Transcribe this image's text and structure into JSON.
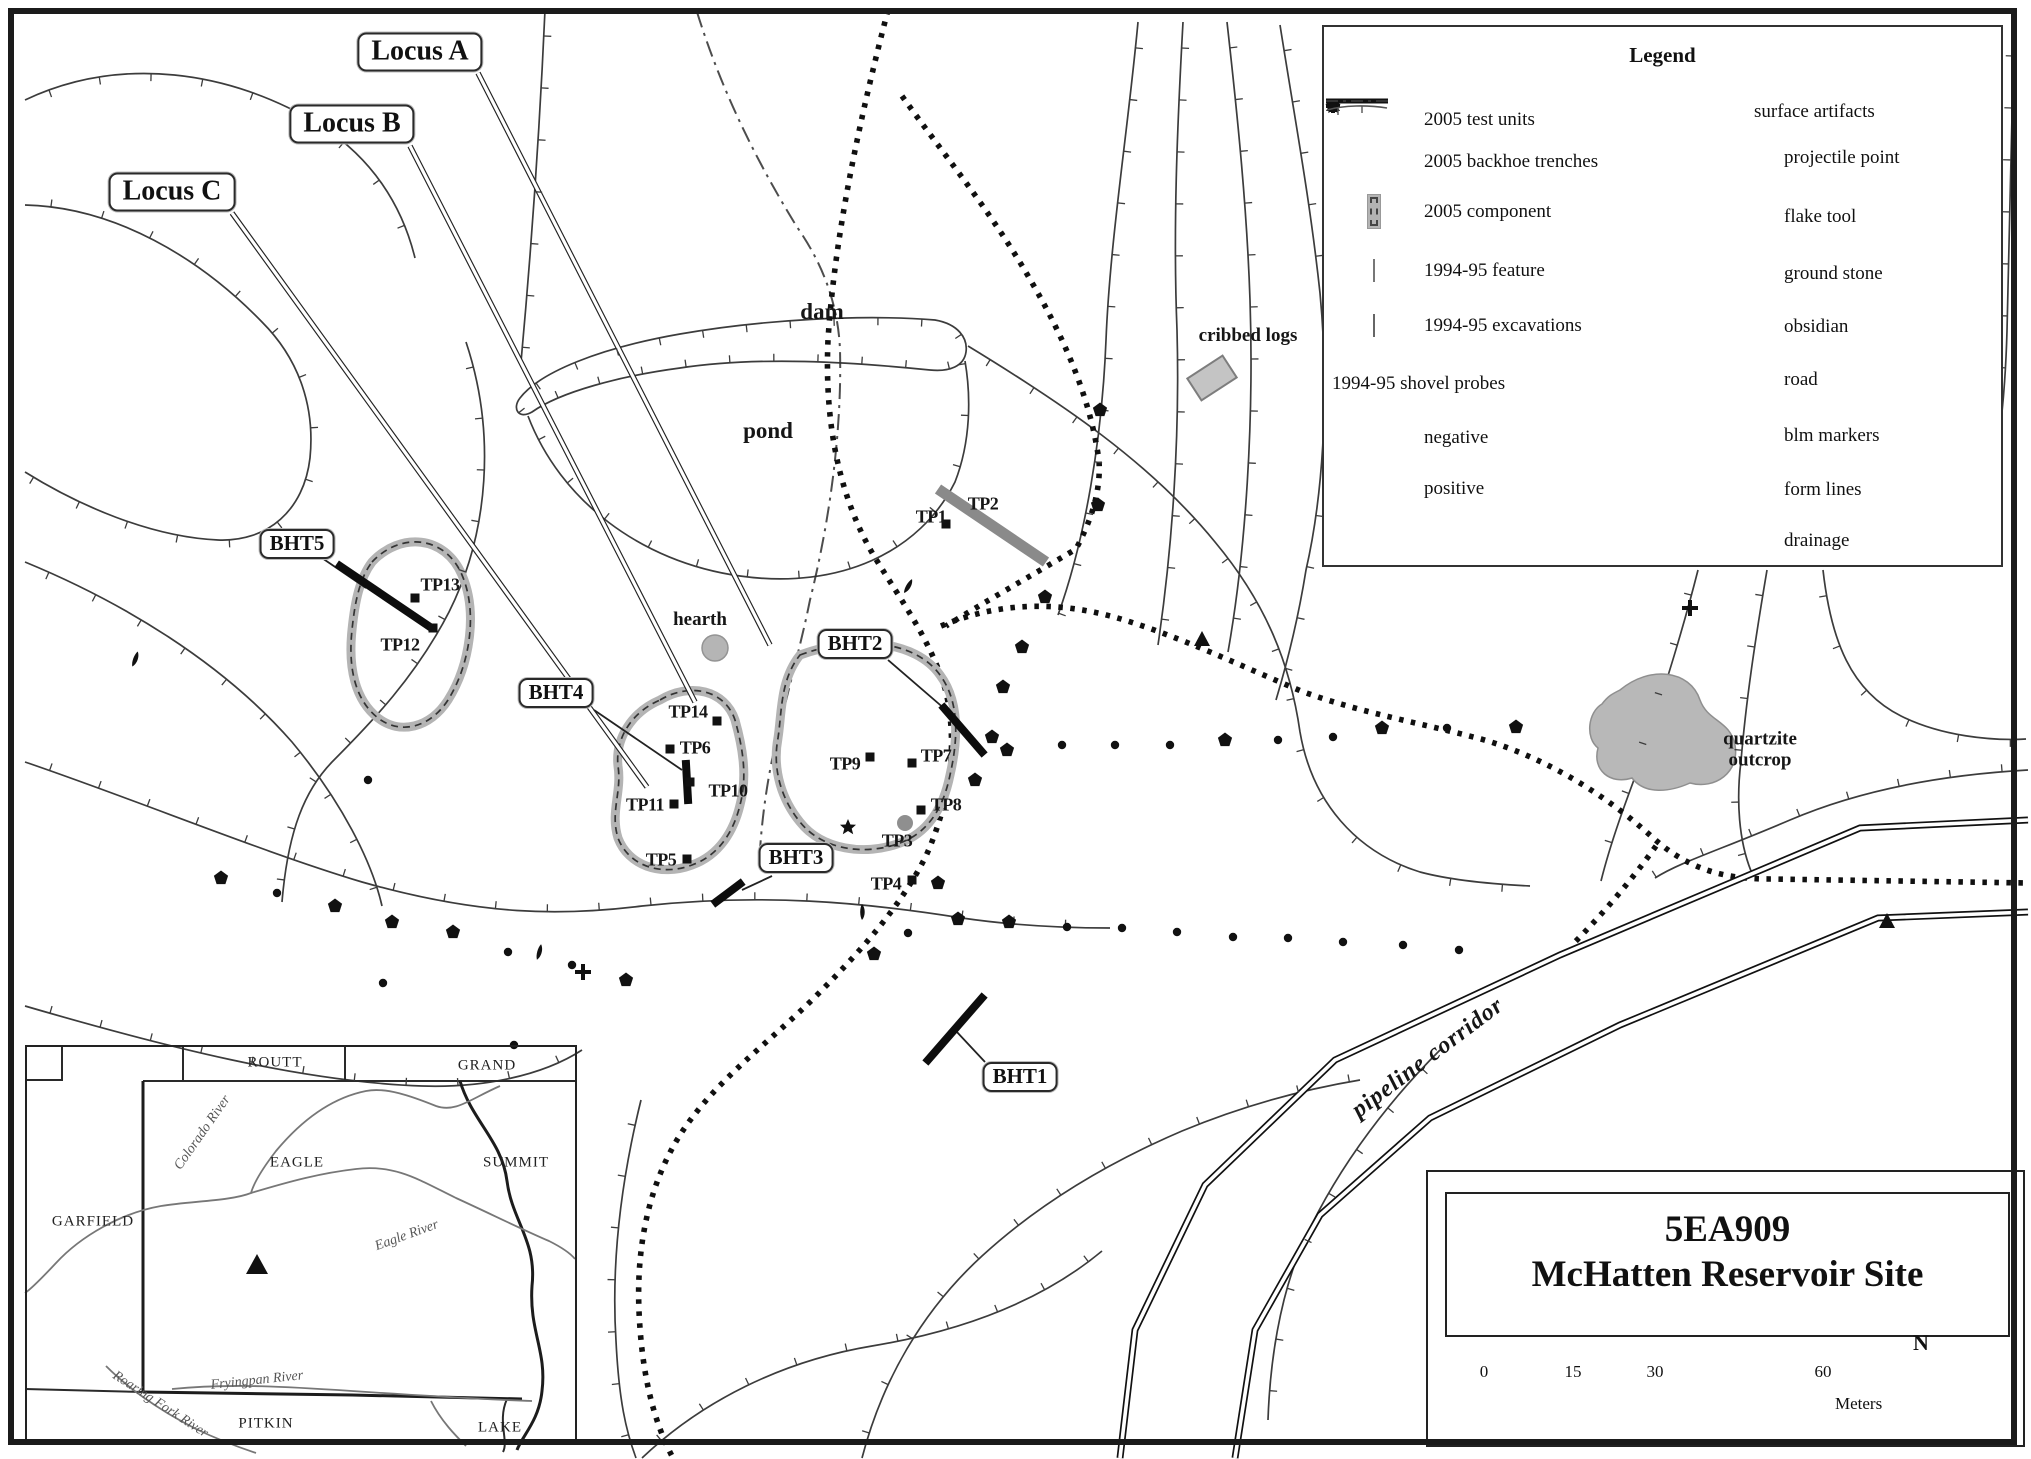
{
  "legend": {
    "title": "Legend",
    "left_items": [
      {
        "icon": "square",
        "label": "2005 test units"
      },
      {
        "icon": "thickline",
        "label": "2005 backhoe trenches"
      },
      {
        "icon": "component",
        "label": "2005 component"
      },
      {
        "icon": "feature",
        "label": "1994-95 feature"
      },
      {
        "icon": "excavation",
        "label": "1994-95 excavations"
      }
    ],
    "probes_heading": "1994-95 shovel probes",
    "probe_items": [
      {
        "icon": "dot",
        "label": "negative"
      },
      {
        "icon": "pentagon",
        "label": "positive"
      }
    ],
    "right_heading": "surface artifacts",
    "right_items": [
      {
        "icon": "leaf",
        "label": "projectile point"
      },
      {
        "icon": "star",
        "label": "flake tool"
      },
      {
        "icon": "cross",
        "label": "ground stone"
      },
      {
        "icon": "smalldot",
        "label": "obsidian"
      },
      {
        "icon": "road",
        "label": "road"
      },
      {
        "icon": "triangle",
        "label": "blm markers"
      },
      {
        "icon": "formline",
        "label": "form lines"
      },
      {
        "icon": "drainage",
        "label": "drainage"
      }
    ]
  },
  "title_block": {
    "site_number": "5EA909",
    "site_name": "McHatten Reservoir Site",
    "scale_ticks": [
      "0",
      "15",
      "30",
      "60"
    ],
    "units_label": "Meters",
    "north_label": "N"
  },
  "map": {
    "callouts": [
      {
        "id": "locus-a",
        "text": "Locus A",
        "x": 420,
        "y": 52,
        "cls": "locus"
      },
      {
        "id": "locus-b",
        "text": "Locus B",
        "x": 352,
        "y": 124,
        "cls": "locus"
      },
      {
        "id": "locus-c",
        "text": "Locus C",
        "x": 172,
        "y": 192,
        "cls": "locus"
      },
      {
        "id": "bht5",
        "text": "BHT5",
        "x": 297,
        "y": 544,
        "cls": "bht"
      },
      {
        "id": "bht4",
        "text": "BHT4",
        "x": 556,
        "y": 693,
        "cls": "bht"
      },
      {
        "id": "bht2",
        "text": "BHT2",
        "x": 855,
        "y": 644,
        "cls": "bht"
      },
      {
        "id": "bht3",
        "text": "BHT3",
        "x": 796,
        "y": 858,
        "cls": "bht"
      },
      {
        "id": "bht1",
        "text": "BHT1",
        "x": 1020,
        "y": 1077,
        "cls": "bht"
      }
    ],
    "labels": [
      {
        "name": "dam-label",
        "text": "dam",
        "x": 822,
        "y": 312,
        "cls": "big"
      },
      {
        "name": "pond-label",
        "text": "pond",
        "x": 768,
        "y": 431,
        "cls": "big"
      },
      {
        "name": "hearth-label",
        "text": "hearth",
        "x": 700,
        "y": 620,
        "cls": "med"
      },
      {
        "name": "cribbed-logs-label",
        "text": "cribbed logs",
        "x": 1248,
        "y": 336,
        "cls": "med"
      },
      {
        "name": "quartzite-label",
        "text": "quartzite outcrop",
        "x": 1760,
        "y": 750,
        "cls": "med wrap"
      },
      {
        "name": "pipeline-label",
        "text": "pipeline corridor",
        "x": 1428,
        "y": 1058,
        "cls": "pipeline",
        "rotate": -37
      }
    ],
    "tp_labels": [
      {
        "text": "TP1",
        "x": 931,
        "y": 517
      },
      {
        "text": "TP2",
        "x": 983,
        "y": 504
      },
      {
        "text": "TP3",
        "x": 897,
        "y": 841
      },
      {
        "text": "TP4",
        "x": 886,
        "y": 884
      },
      {
        "text": "TP5",
        "x": 661,
        "y": 860
      },
      {
        "text": "TP6",
        "x": 695,
        "y": 748
      },
      {
        "text": "TP7",
        "x": 936,
        "y": 756
      },
      {
        "text": "TP8",
        "x": 946,
        "y": 805
      },
      {
        "text": "TP9",
        "x": 845,
        "y": 764
      },
      {
        "text": "TP10",
        "x": 728,
        "y": 791
      },
      {
        "text": "TP11",
        "x": 645,
        "y": 805
      },
      {
        "text": "TP12",
        "x": 400,
        "y": 645
      },
      {
        "text": "TP13",
        "x": 440,
        "y": 585
      },
      {
        "text": "TP14",
        "x": 688,
        "y": 712
      }
    ],
    "markers": {
      "test_units": [
        [
          415,
          598
        ],
        [
          717,
          721
        ],
        [
          670,
          749
        ],
        [
          690,
          782
        ],
        [
          674,
          804
        ],
        [
          687,
          859
        ],
        [
          870,
          757
        ],
        [
          912,
          763
        ],
        [
          921,
          810
        ],
        [
          912,
          880
        ],
        [
          433,
          628
        ],
        [
          946,
          524
        ]
      ],
      "pentagons": [
        [
          221,
          878
        ],
        [
          335,
          906
        ],
        [
          392,
          922
        ],
        [
          453,
          932
        ],
        [
          626,
          980
        ],
        [
          874,
          954
        ],
        [
          938,
          883
        ],
        [
          958,
          919
        ],
        [
          1009,
          922
        ],
        [
          975,
          780
        ],
        [
          992,
          737
        ],
        [
          1007,
          750
        ],
        [
          1003,
          687
        ],
        [
          1022,
          647
        ],
        [
          1045,
          597
        ],
        [
          1098,
          505
        ],
        [
          1100,
          410
        ],
        [
          1225,
          740
        ],
        [
          1382,
          728
        ],
        [
          1516,
          727
        ]
      ],
      "dots": [
        [
          277,
          893
        ],
        [
          368,
          780
        ],
        [
          383,
          983
        ],
        [
          508,
          952
        ],
        [
          572,
          965
        ],
        [
          514,
          1045
        ],
        [
          908,
          933
        ],
        [
          1062,
          745
        ],
        [
          1115,
          745
        ],
        [
          1170,
          745
        ],
        [
          1278,
          740
        ],
        [
          1333,
          737
        ],
        [
          1447,
          728
        ],
        [
          1067,
          927
        ],
        [
          1122,
          928
        ],
        [
          1177,
          932
        ],
        [
          1233,
          937
        ],
        [
          1288,
          938
        ],
        [
          1343,
          942
        ],
        [
          1403,
          945
        ],
        [
          1459,
          950
        ]
      ],
      "diamonds": [
        [
          135,
          659,
          20
        ],
        [
          539,
          952,
          15
        ],
        [
          862,
          912,
          0
        ],
        [
          908,
          586,
          30
        ]
      ],
      "stars": [
        [
          848,
          827
        ]
      ],
      "crosses": [
        [
          583,
          972
        ],
        [
          1690,
          608
        ]
      ],
      "triangles": [
        [
          1202,
          640
        ],
        [
          1887,
          922
        ]
      ],
      "gray_dots": [
        [
          905,
          823
        ]
      ]
    }
  },
  "inset": {
    "counties": [
      {
        "name": "ROUTT",
        "x": 275,
        "y": 1063
      },
      {
        "name": "GRAND",
        "x": 487,
        "y": 1066
      },
      {
        "name": "EAGLE",
        "x": 297,
        "y": 1163
      },
      {
        "name": "GARFIELD",
        "x": 93,
        "y": 1222
      },
      {
        "name": "SUMMIT",
        "x": 516,
        "y": 1163
      },
      {
        "name": "PITKIN",
        "x": 266,
        "y": 1424
      },
      {
        "name": "LAKE",
        "x": 500,
        "y": 1428
      }
    ],
    "rivers": [
      {
        "name": "Colorado River",
        "x": 203,
        "y": 1133,
        "rotate": -55
      },
      {
        "name": "Eagle River",
        "x": 407,
        "y": 1236,
        "rotate": -20
      },
      {
        "name": "Fryingpan River",
        "x": 257,
        "y": 1381,
        "rotate": -6
      },
      {
        "name": "Roaring Fork River",
        "x": 160,
        "y": 1405,
        "rotate": 33
      }
    ]
  }
}
